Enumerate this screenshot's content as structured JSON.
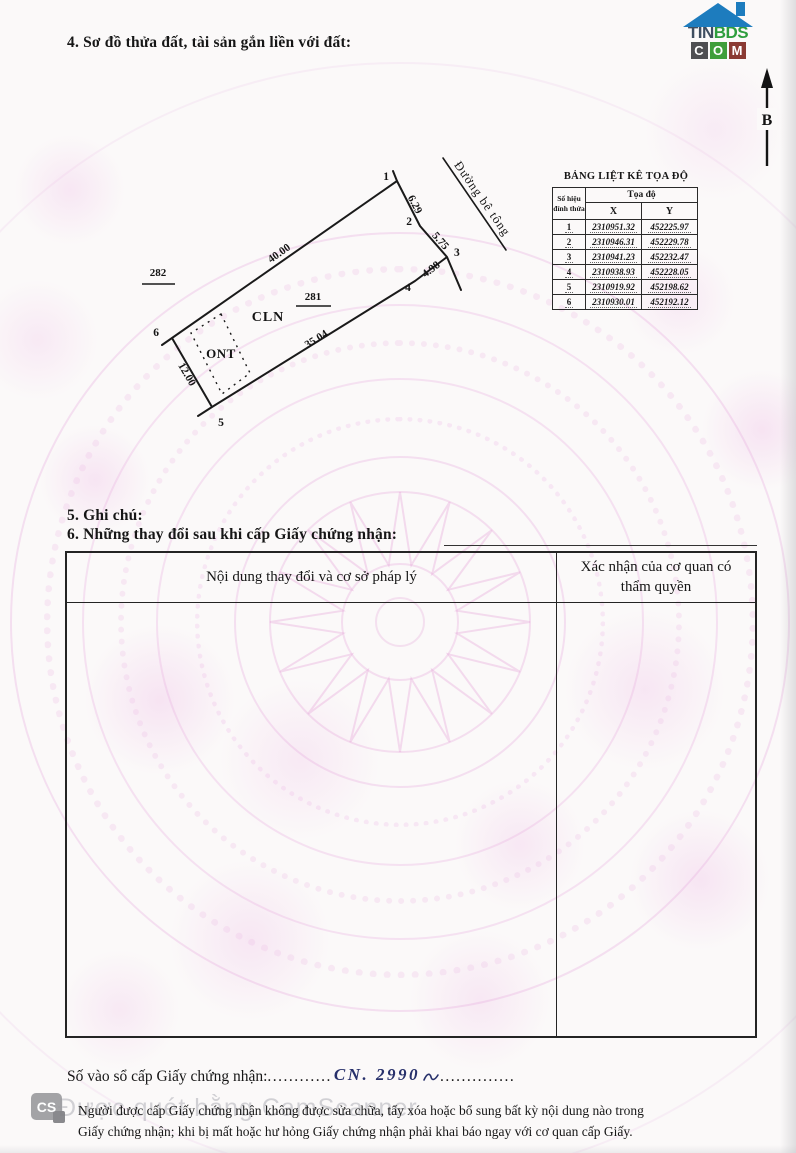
{
  "sections": {
    "section4_title": "4. Sơ đồ thửa đất, tài sản gắn liền với đất:",
    "section5_title": "5. Ghi chú:",
    "section6_title": "6. Những thay đổi sau khi cấp Giấy chứng nhận:"
  },
  "logo": {
    "tin": "TIN",
    "bds": "BDS",
    "c": "C",
    "o": "O",
    "m": "M"
  },
  "compass": {
    "north_label": "B"
  },
  "diagram": {
    "plot_number": "281",
    "adjacent_plot_number": "282",
    "land_type_main": "CLN",
    "land_type_residential": "ONT",
    "road_label": "Đường bê tông",
    "edges": {
      "e12": "6.29",
      "e23": "5.75",
      "e34": "4.98",
      "e45": "35.04",
      "e56": "12.00",
      "e61": "40.00"
    },
    "vertices": [
      "1",
      "2",
      "3",
      "4",
      "5",
      "6"
    ]
  },
  "coord_table": {
    "title": "BẢNG LIỆT KÊ TỌA ĐỘ",
    "vertex_col": "Số hiệu đỉnh thửa",
    "coord_col": "Tọa độ",
    "x_col": "X",
    "y_col": "Y",
    "rows": [
      [
        "1",
        "2310951.32",
        "452225.97"
      ],
      [
        "2",
        "2310946.31",
        "452229.78"
      ],
      [
        "3",
        "2310941.23",
        "452232.47"
      ],
      [
        "4",
        "2310938.93",
        "452228.05"
      ],
      [
        "5",
        "2310919.92",
        "452198.62"
      ],
      [
        "6",
        "2310930.01",
        "452192.12"
      ]
    ]
  },
  "change_table": {
    "col_content": "Nội dung thay đổi và cơ sở pháp lý",
    "col_confirm": "Xác nhận của cơ quan có thẩm quyền"
  },
  "footer": {
    "registry_label": "Số vào sổ cấp Giấy chứng nhận:",
    "registry_dots_left": "............",
    "registry_value": "CN. 2990",
    "registry_dots_right": "..............",
    "notice_line1": "Người được cấp Giấy chứng nhận không được sửa chữa, tẩy xóa hoặc bổ sung bất kỳ nội dung nào trong",
    "notice_line2": "Giấy chứng nhận; khi bị mất hoặc hư hỏng Giấy chứng nhận phải khai báo ngay với cơ quan cấp Giấy.",
    "camscanner_badge": "CS",
    "camscanner_watermark": "Được quét bằng CamScanner"
  },
  "colors": {
    "watermark_pink": "#e9aede",
    "ink_handwriting": "#27306b",
    "logo_blue": "#1d7cbe",
    "logo_green": "#2f9e3e",
    "logo_dark": "#3f4e60",
    "logo_box_gray": "#4f4f52",
    "logo_box_red": "#8a3a33",
    "text_black": "#161616"
  }
}
